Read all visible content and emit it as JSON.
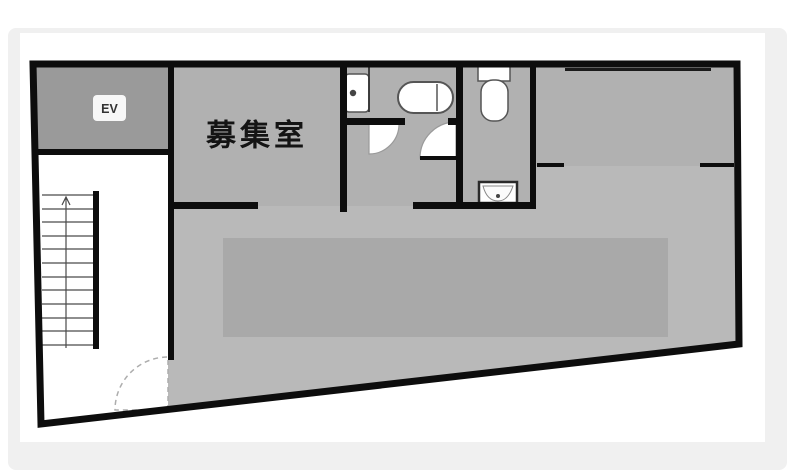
{
  "page": {
    "background": "#ffffff",
    "panel_bg": "#f0f0f0",
    "scan_bg": "#ffffff"
  },
  "floorplan": {
    "labels": {
      "vacant_room": "募集室",
      "elevator": "EV"
    },
    "colors": {
      "wall": "#0d0d0d",
      "room_fill": "#b1b1b1",
      "open_area_fill": "#b9b9b9",
      "inner_zone_fill": "#a9a9a9",
      "elevator_fill": "#9a9a9a",
      "stairwell_fill": "#ffffff",
      "door_arc_fill": "#ffffff",
      "fixture_fill": "#ffffff",
      "fixture_stroke": "#555555",
      "stair_line": "#4a4a4a"
    }
  }
}
